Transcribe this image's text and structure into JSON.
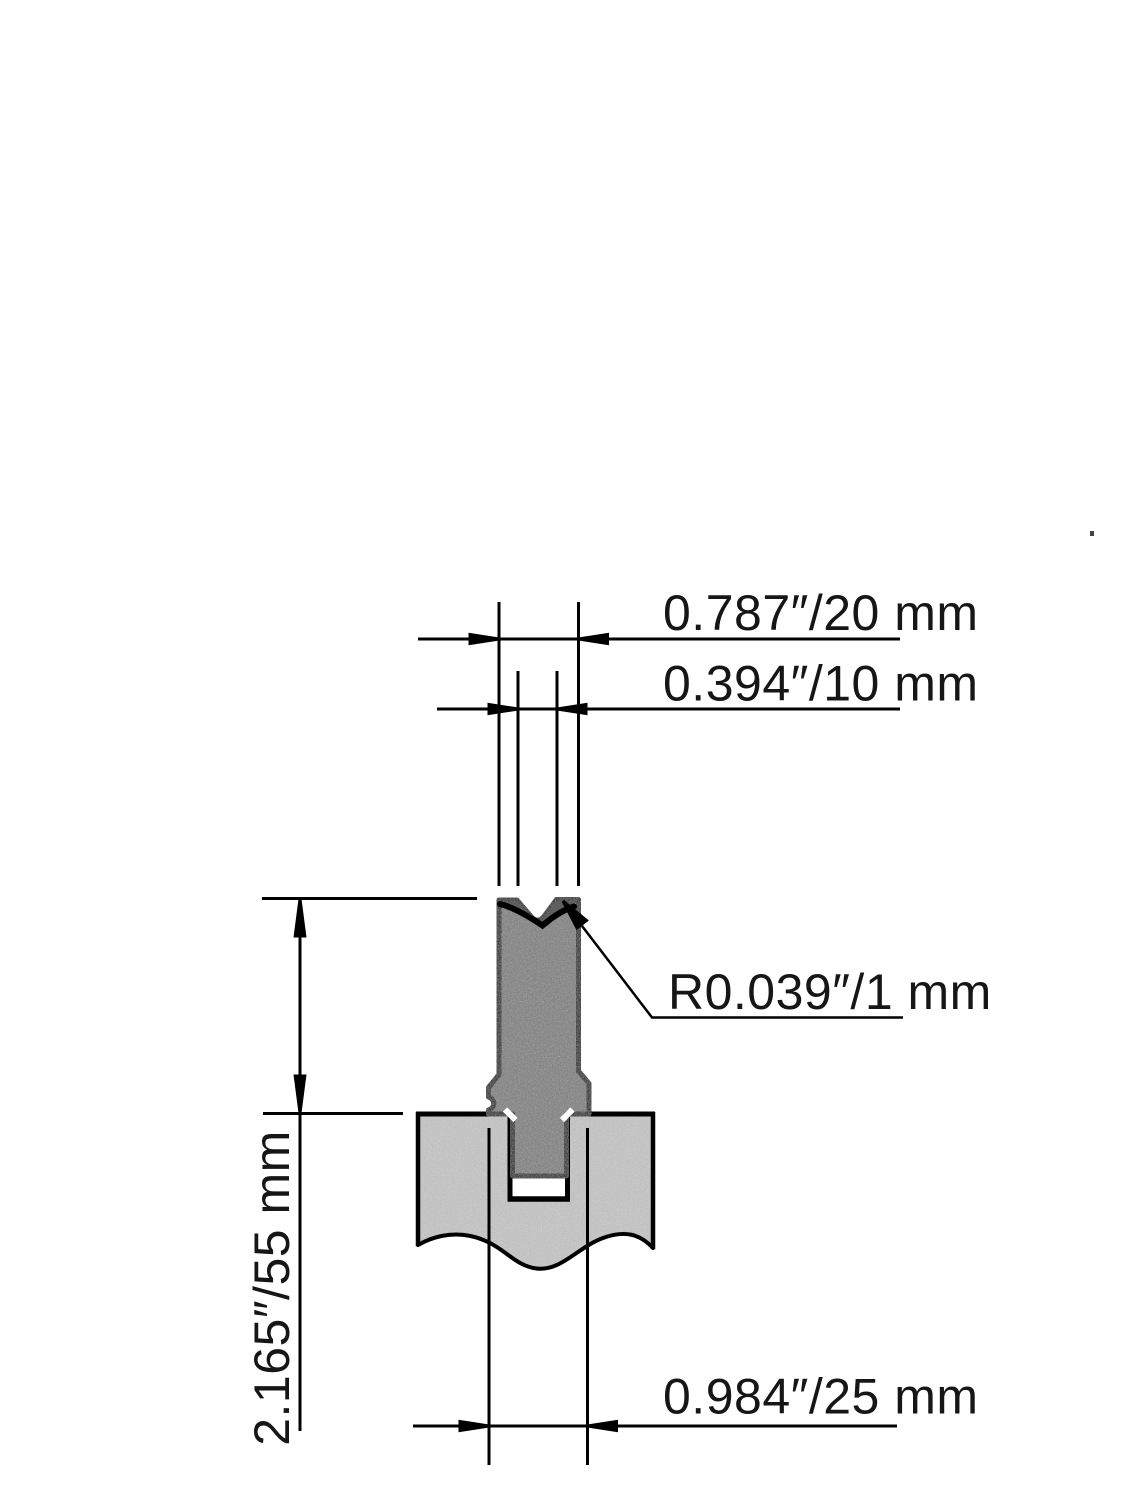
{
  "diagram": {
    "labels": {
      "top_width": "0.787″/20 mm",
      "groove_width": "0.394″/10 mm",
      "shoulder_radius": "R0.039″/1 mm",
      "height": "2.165″/55 mm",
      "base_width": "0.984″/25 mm"
    },
    "values": {
      "top_width_in": 0.787,
      "top_width_mm": 20,
      "groove_width_in": 0.394,
      "groove_width_mm": 10,
      "shoulder_radius_in": 0.039,
      "shoulder_radius_mm": 1,
      "height_in": 2.165,
      "height_mm": 55,
      "base_width_in": 0.984,
      "base_width_mm": 25
    },
    "colors": {
      "die_fill": "#7e7e7e",
      "groove_fill": "#5f5f5f",
      "holder_fill": "#c6c6c6",
      "line": "#000000",
      "text": "#161616",
      "background": "#ffffff"
    }
  }
}
